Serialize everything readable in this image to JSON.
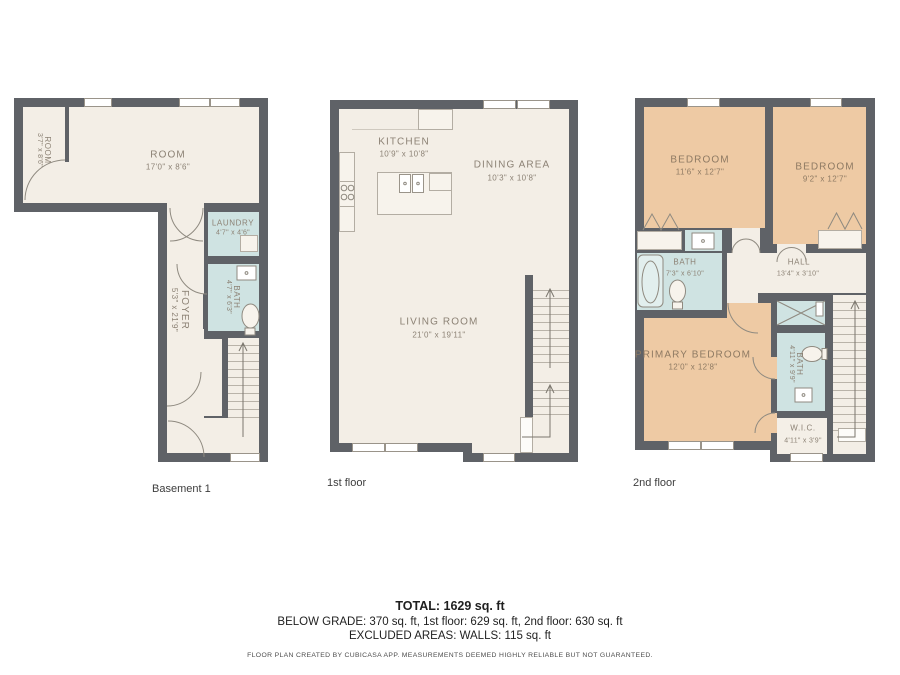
{
  "colors": {
    "wall": "#5f6267",
    "floor": "#f3eee6",
    "wet": "#cfe3e2",
    "bedroom": "#eecaa4",
    "label": "#8c8275"
  },
  "floors": {
    "basement": {
      "label": "Basement 1",
      "rooms": {
        "side_room": {
          "name": "ROOM",
          "dims": "3'7\" x 8'6\""
        },
        "main_room": {
          "name": "ROOM",
          "dims": "17'0\" x 8'6\""
        },
        "laundry": {
          "name": "LAUNDRY",
          "dims": "4'7\" x 4'6\""
        },
        "bath": {
          "name": "BATH",
          "dims": "4'7\" x 6'3\""
        },
        "foyer": {
          "name": "FOYER",
          "dims": "5'3\" x 21'9\""
        }
      }
    },
    "first": {
      "label": "1st floor",
      "rooms": {
        "kitchen": {
          "name": "KITCHEN",
          "dims": "10'9\" x 10'8\""
        },
        "dining": {
          "name": "DINING AREA",
          "dims": "10'3\" x 10'8\""
        },
        "living": {
          "name": "LIVING ROOM",
          "dims": "21'0\" x 19'11\""
        }
      }
    },
    "second": {
      "label": "2nd floor",
      "rooms": {
        "bedroom_left": {
          "name": "BEDROOM",
          "dims": "11'6\" x 12'7\""
        },
        "bedroom_right": {
          "name": "BEDROOM",
          "dims": "9'2\" x 12'7\""
        },
        "bath_main": {
          "name": "BATH",
          "dims": "7'3\" x 6'10\""
        },
        "hall": {
          "name": "HALL",
          "dims": "13'4\" x 3'10\""
        },
        "primary": {
          "name": "PRIMARY BEDROOM",
          "dims": "12'0\" x 12'8\""
        },
        "bath_ensuite": {
          "name": "BATH",
          "dims": "4'11\" x 9'9\""
        },
        "wic": {
          "name": "W.I.C.",
          "dims": "4'11\" x 3'9\""
        }
      }
    }
  },
  "summary": {
    "total": "TOTAL: 1629 sq. ft",
    "breakdown": "BELOW GRADE: 370 sq. ft, 1st floor: 629 sq. ft, 2nd floor: 630 sq. ft",
    "excluded": "EXCLUDED AREAS: WALLS: 115 sq. ft",
    "disclaimer": "FLOOR PLAN CREATED BY CUBICASA APP. MEASUREMENTS DEEMED HIGHLY RELIABLE BUT NOT GUARANTEED."
  }
}
